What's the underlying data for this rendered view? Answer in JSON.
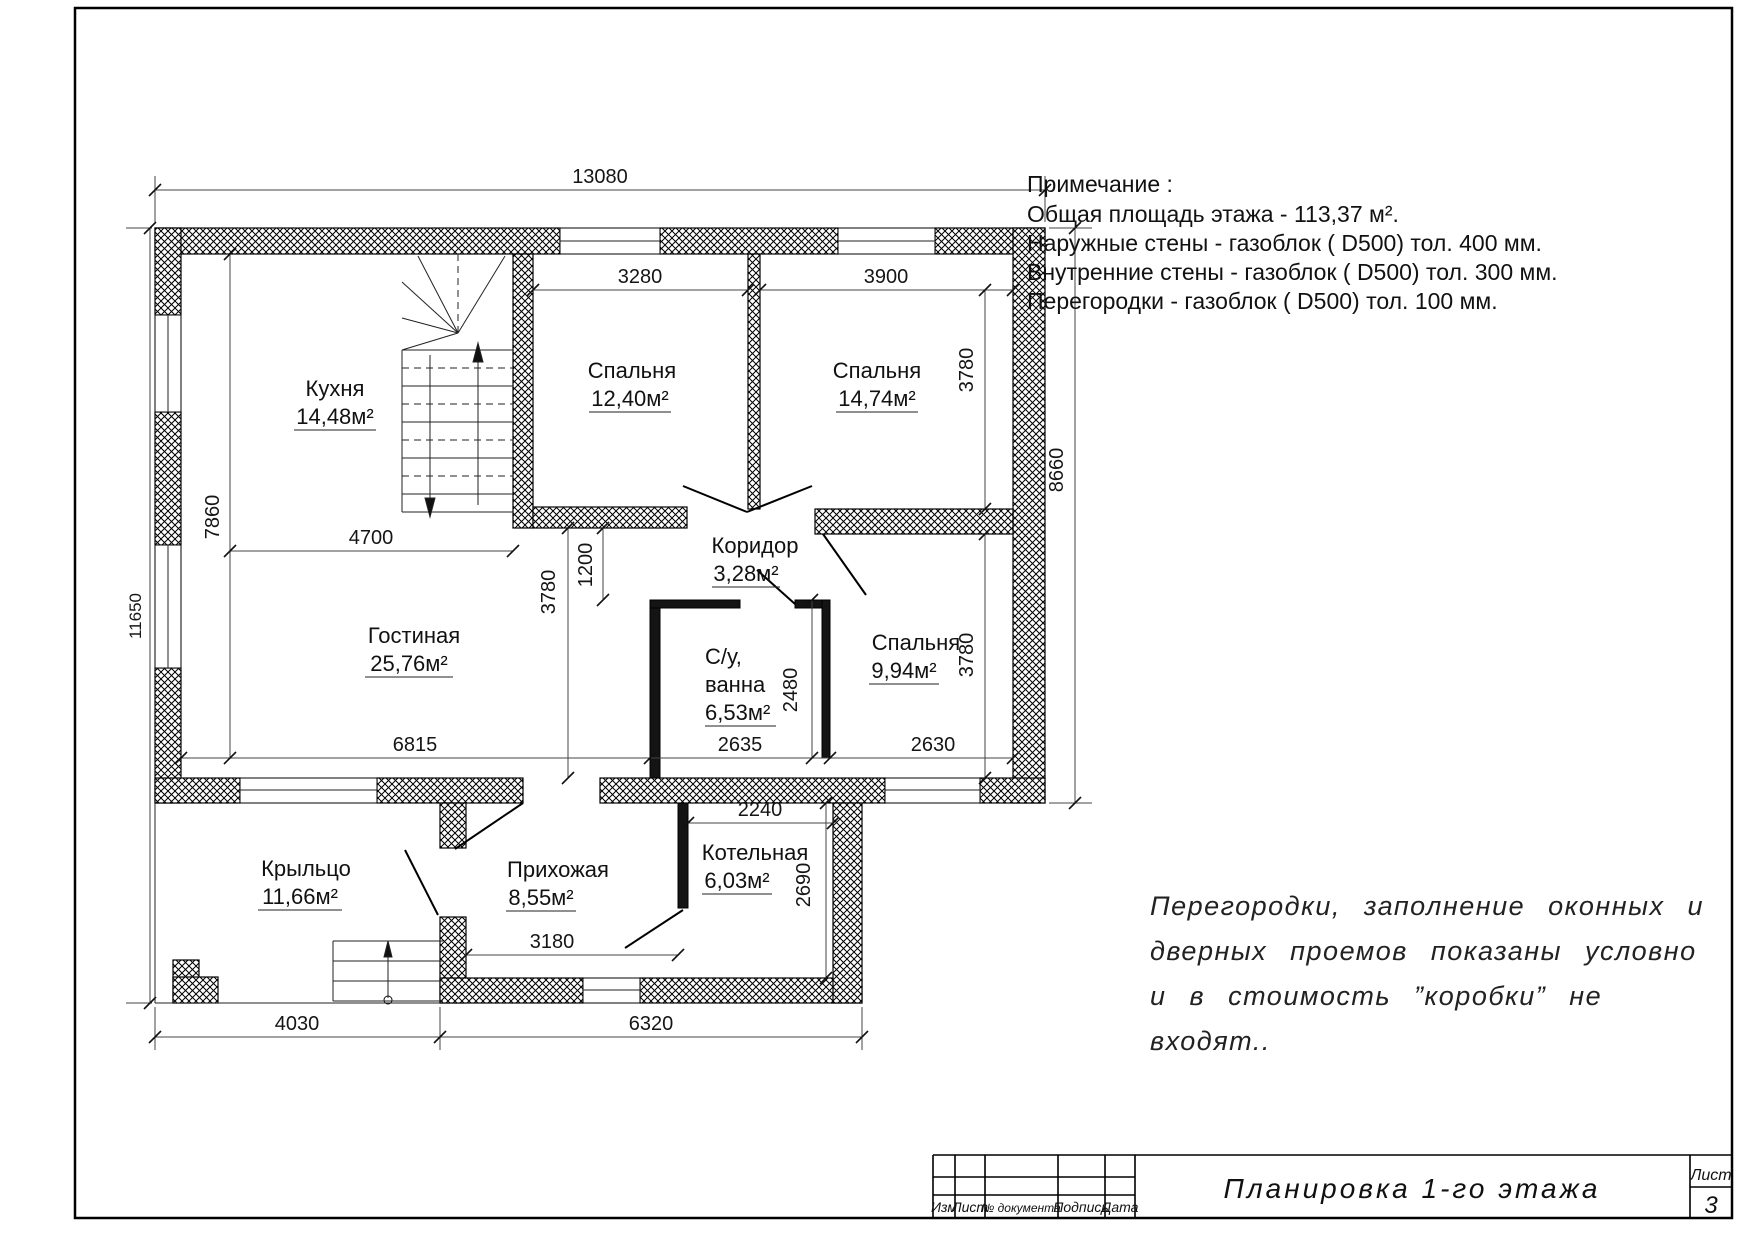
{
  "notes": {
    "heading": "Примечание :",
    "line1": "Общая площадь этажа - 113,37 м².",
    "line2": "Наружные стены - газоблок ( D500) тол. 400 мм.",
    "line3": "Внутренние стены - газоблок ( D500) тол. 300 мм.",
    "line4": "Перегородки - газоблок ( D500) тол. 100 мм."
  },
  "disclaimer": {
    "line1": "Перегородки, заполнение оконных и",
    "line2": "дверных проемов показаны условно",
    "line3": "и в стоимость ”коробки” не",
    "line4": "входят.."
  },
  "title_block": {
    "col_izm": "Изм",
    "col_list": "Лист",
    "col_doc": "№ документа",
    "col_sign": "Подпись",
    "col_date": "Дата",
    "title": "Планировка 1-го этажа",
    "sheet_label": "Лист",
    "sheet_number": "3"
  },
  "rooms": [
    {
      "name": "Кухня",
      "area": "14,48м²"
    },
    {
      "name": "Спальня",
      "area": "12,40м²"
    },
    {
      "name": "Спальня",
      "area": "14,74м²"
    },
    {
      "name": "Коридор",
      "area": "3,28м²"
    },
    {
      "name": "Гостиная",
      "area": "25,76м²"
    },
    {
      "name": "С/у,",
      "name2": "ванна",
      "area": "6,53м²"
    },
    {
      "name": "Спальня",
      "area": "9,94м²"
    },
    {
      "name": "Крыльцо",
      "area": "11,66м²"
    },
    {
      "name": "Прихожая",
      "area": "8,55м²"
    },
    {
      "name": "Котельная",
      "area": "6,03м²"
    }
  ],
  "dims": {
    "top_overall": "13080",
    "bed1_w": "3280",
    "bed2_w": "3900",
    "bed2_h": "3780",
    "bed3_h": "3780",
    "right_overall": "8660",
    "left_overall": "11650",
    "kitchen_h": "7860",
    "kitchen_w": "4700",
    "corridor_w": "1200",
    "living_h": "3780",
    "bath_h": "2480",
    "living_w": "6815",
    "bath_w": "2635",
    "bed3_w": "2630",
    "boiler_w": "2240",
    "boiler_h": "2690",
    "hall_w": "3180",
    "porch_w": "4030",
    "ext_w": "6320"
  }
}
